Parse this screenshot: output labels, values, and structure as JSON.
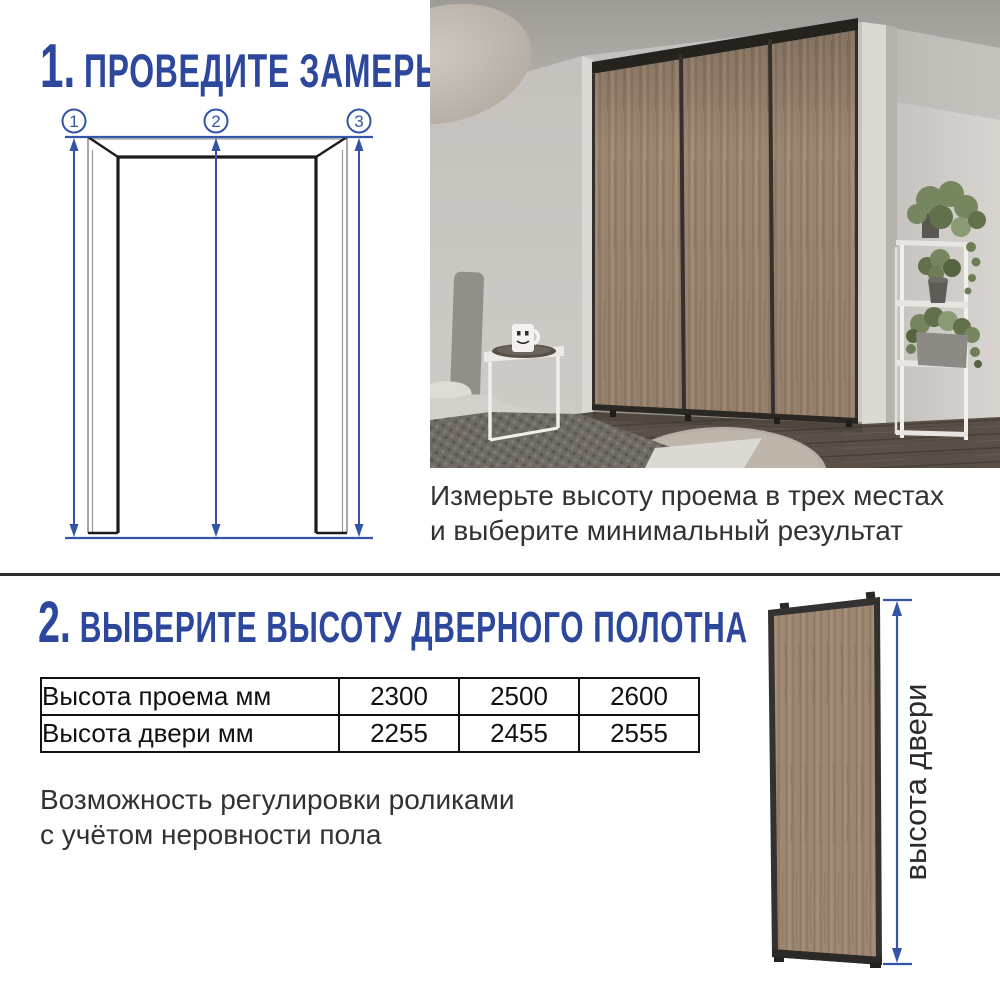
{
  "colors": {
    "accent_blue": "#2c479c",
    "arrow_blue": "#3454a8",
    "wood_tone": "#9c8672",
    "divider_dark": "#2e2e2e",
    "text_dark": "#323232"
  },
  "section1": {
    "step_number": "1.",
    "title": "ПРОВЕДИТЕ ЗАМЕРЫ",
    "diagram": {
      "markers": [
        "1",
        "2",
        "3"
      ]
    },
    "caption_line1": "Измерьте высоту проема в трех местах",
    "caption_line2": "и выберите минимальный результат"
  },
  "section2": {
    "step_number": "2.",
    "title": "ВЫБЕРИТЕ ВЫСОТУ ДВЕРНОГО ПОЛОТНА",
    "table": {
      "rows": [
        {
          "label": "Высота проема мм",
          "values": [
            "2300",
            "2500",
            "2600"
          ]
        },
        {
          "label": "Высота двери мм",
          "values": [
            "2255",
            "2455",
            "2555"
          ]
        }
      ]
    },
    "note_line1": "Возможность регулировки роликами",
    "note_line2": "с учётом неровности пола",
    "door_label": "высота двери"
  }
}
